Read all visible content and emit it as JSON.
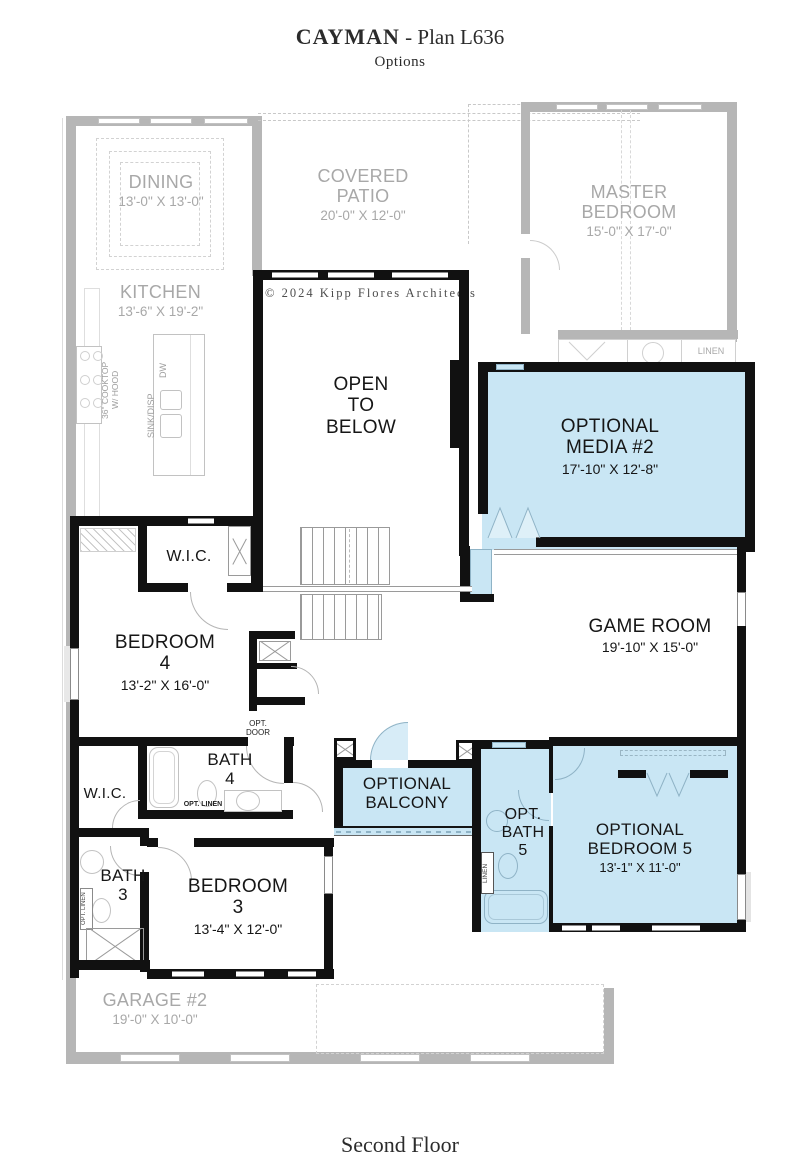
{
  "header": {
    "title_main": "CAYMAN",
    "title_rest": " - Plan L636",
    "subtitle": "Options"
  },
  "footer": {
    "caption": "Second Floor"
  },
  "copyright": "© 2024 Kipp Flores Architects",
  "colors": {
    "optional_fill": "#c9e6f4",
    "wall_black": "#111111",
    "wall_gray": "#b6b6b6",
    "gray_text": "#a8a8a8"
  },
  "rooms": {
    "dining": {
      "name": "DINING",
      "dims": "13'-0\" X 13'-0\""
    },
    "kitchen": {
      "name": "KITCHEN",
      "dims": "13'-6\" X 19'-2\""
    },
    "covered_patio": {
      "name": "COVERED\nPATIO",
      "dims": "20'-0\" X 12'-0\""
    },
    "master_bedroom": {
      "name": "MASTER\nBEDROOM",
      "dims": "15'-0\" X 17'-0\""
    },
    "open_to_below": {
      "name": "OPEN\nTO\nBELOW"
    },
    "optional_media": {
      "name": "OPTIONAL\nMEDIA #2",
      "dims": "17'-10\" X 12'-8\""
    },
    "game_room": {
      "name": "GAME ROOM",
      "dims": "19'-10\" X 15'-0\""
    },
    "wic_upper": {
      "name": "W.I.C."
    },
    "bedroom_4": {
      "name": "BEDROOM\n4",
      "dims": "13'-2\" X 16'-0\""
    },
    "bath_4": {
      "name": "BATH\n4"
    },
    "wic_lower": {
      "name": "W.I.C."
    },
    "bath_3": {
      "name": "BATH\n3"
    },
    "bedroom_3": {
      "name": "BEDROOM\n3",
      "dims": "13'-4\" X 12'-0\""
    },
    "optional_balcony": {
      "name": "OPTIONAL\nBALCONY"
    },
    "opt_bath_5": {
      "name": "OPT.\nBATH\n5"
    },
    "optional_bedroom_5": {
      "name": "OPTIONAL\nBEDROOM 5",
      "dims": "13'-1\" X 11'-0\""
    },
    "garage_2": {
      "name": "GARAGE #2",
      "dims": "19'-0\" X 10'-0\""
    }
  },
  "labels": {
    "linen_master": "LINEN",
    "linen_bath5": "LINEN",
    "opt_door": "OPT.\nDOOR",
    "opt_linen_bath4": "OPT. LINEN",
    "opt_linen_bath3": "OPT. LINEN",
    "cooktop": "36\" COOKTOP\nW/ HOOD",
    "sink_disp": "SINK/DISP",
    "dw": "DW"
  }
}
